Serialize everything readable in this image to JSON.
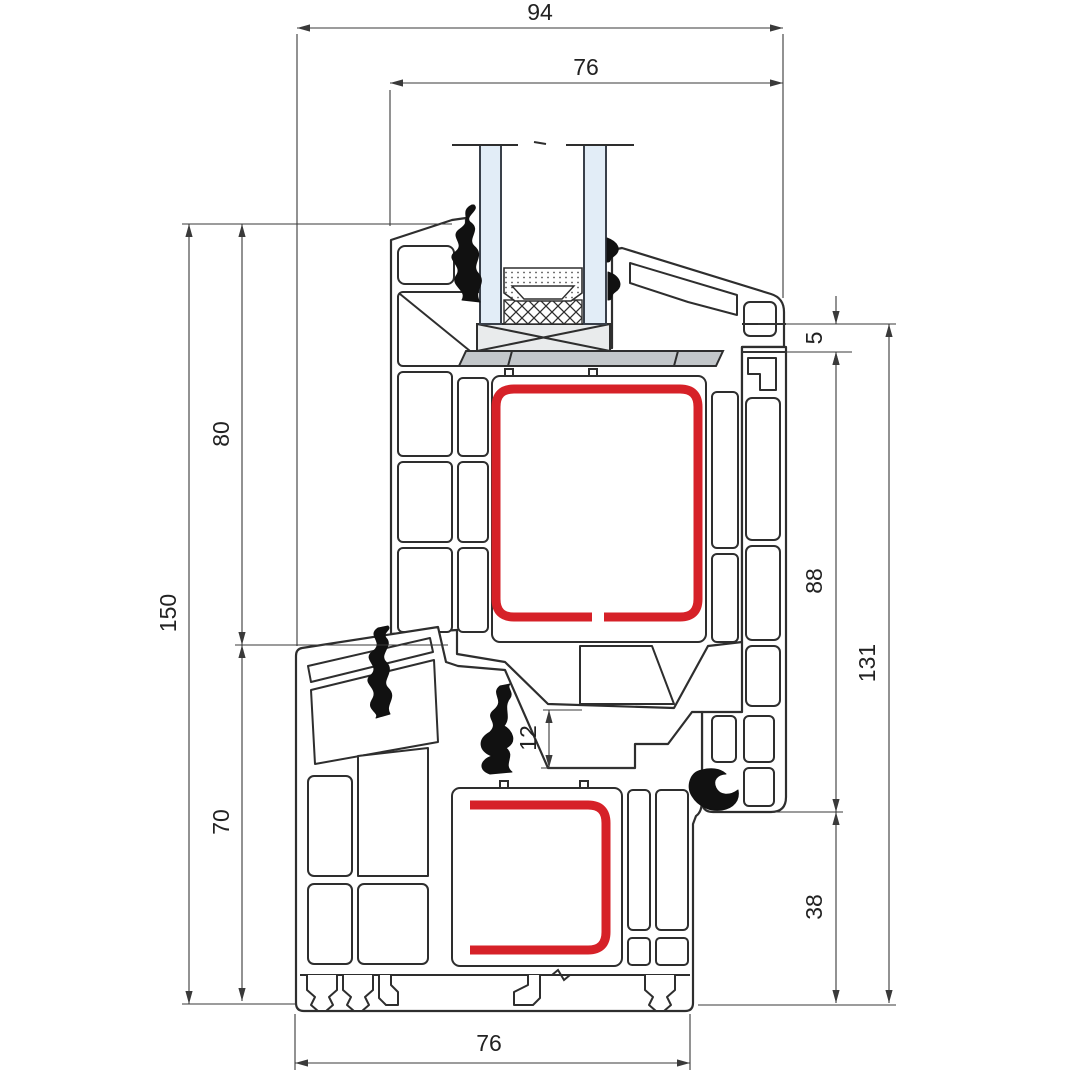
{
  "drawing": {
    "type": "window-profile-cross-section",
    "dimensions": [
      {
        "id": "overall-face-width",
        "value": "94",
        "axis": "h",
        "y": 28,
        "x1": 297,
        "x2": 783,
        "tx": 540,
        "ty": 20
      },
      {
        "id": "sash-depth",
        "value": "76",
        "axis": "h",
        "y": 83,
        "x1": 390,
        "x2": 783,
        "tx": 586,
        "ty": 75
      },
      {
        "id": "total-height",
        "value": "150",
        "axis": "v",
        "x": 189,
        "y1": 224,
        "y2": 1004,
        "tx": 176,
        "ty": 613
      },
      {
        "id": "sash-height",
        "value": "80",
        "axis": "v",
        "x": 242,
        "y1": 224,
        "y2": 645,
        "tx": 229,
        "ty": 434
      },
      {
        "id": "frame-height",
        "value": "70",
        "axis": "v",
        "x": 242,
        "y1": 645,
        "y2": 1001,
        "tx": 229,
        "ty": 822
      },
      {
        "id": "overlap-offset",
        "value": "5",
        "axis": "v",
        "x": 836,
        "y1": 324,
        "y2": 352,
        "tx": 822,
        "ty": 338,
        "arrows": "outside"
      },
      {
        "id": "rebate-height",
        "value": "88",
        "axis": "v",
        "x": 836,
        "y1": 352,
        "y2": 812,
        "tx": 822,
        "ty": 581
      },
      {
        "id": "lower-height",
        "value": "38",
        "axis": "v",
        "x": 836,
        "y1": 812,
        "y2": 1003,
        "tx": 822,
        "ty": 907
      },
      {
        "id": "frame-total-height",
        "value": "131",
        "axis": "v",
        "x": 889,
        "y1": 324,
        "y2": 1003,
        "tx": 875,
        "ty": 663
      },
      {
        "id": "rebate-gap",
        "value": "12",
        "axis": "v",
        "x": 549,
        "y1": 710,
        "y2": 768,
        "tx": 536,
        "ty": 738
      },
      {
        "id": "frame-bottom-width",
        "value": "76",
        "axis": "h",
        "y": 1063,
        "x1": 295,
        "x2": 690,
        "tx": 489,
        "ty": 1051
      }
    ],
    "colors": {
      "steel_reinforcement": "#d62128",
      "glass": "#e2edf7",
      "glazing_strip": "#c3c7ca",
      "packer": "#e9ebec",
      "outline": "#2e2e2e",
      "dimension": "#3a3a3a",
      "gasket": "#111111"
    }
  }
}
